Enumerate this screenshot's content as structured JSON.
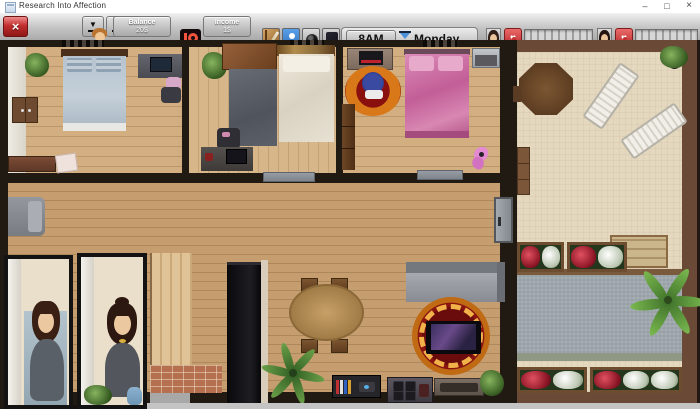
{
  "window": {
    "title": "Research Into Affection",
    "controls": {
      "minimize": "–",
      "maximize": "□",
      "close": "×"
    }
  },
  "toolbar": {
    "exit_button": "×",
    "save_glyph": "▼",
    "load_glyph": "▲",
    "balance": {
      "label": "Balance",
      "value": "20$",
      "badge": "$"
    },
    "income": {
      "label": "Income",
      "value": "1$"
    },
    "time": {
      "hour": "8AM",
      "day": "Monday"
    },
    "status": {
      "heart_glyph": "♥",
      "progress_percent_1": 0,
      "progress_percent_2": 0
    }
  },
  "scene": {
    "rooms": [
      "bedroom-left",
      "bedroom-middle",
      "bedroom-pink",
      "living-room",
      "bathroom-stalls",
      "kitchen",
      "dining-area",
      "patio",
      "pool-area"
    ],
    "characters": [
      "character-1",
      "character-2"
    ]
  },
  "colors": {
    "exit_red": "#c22f2f",
    "heart_red": "#d24343",
    "patreon_orange": "#f4543e",
    "roster_blue": "#3a84d6",
    "hourglass_blue": "#4a90d8",
    "wood_floor": "#d2ae80",
    "living_floor": "#c69d6e",
    "patio_sand": "#e4d8bf",
    "pool_grey": "#9fa8ae",
    "rug_red": "#8a1410",
    "bed_pink": "#d06aa8"
  }
}
